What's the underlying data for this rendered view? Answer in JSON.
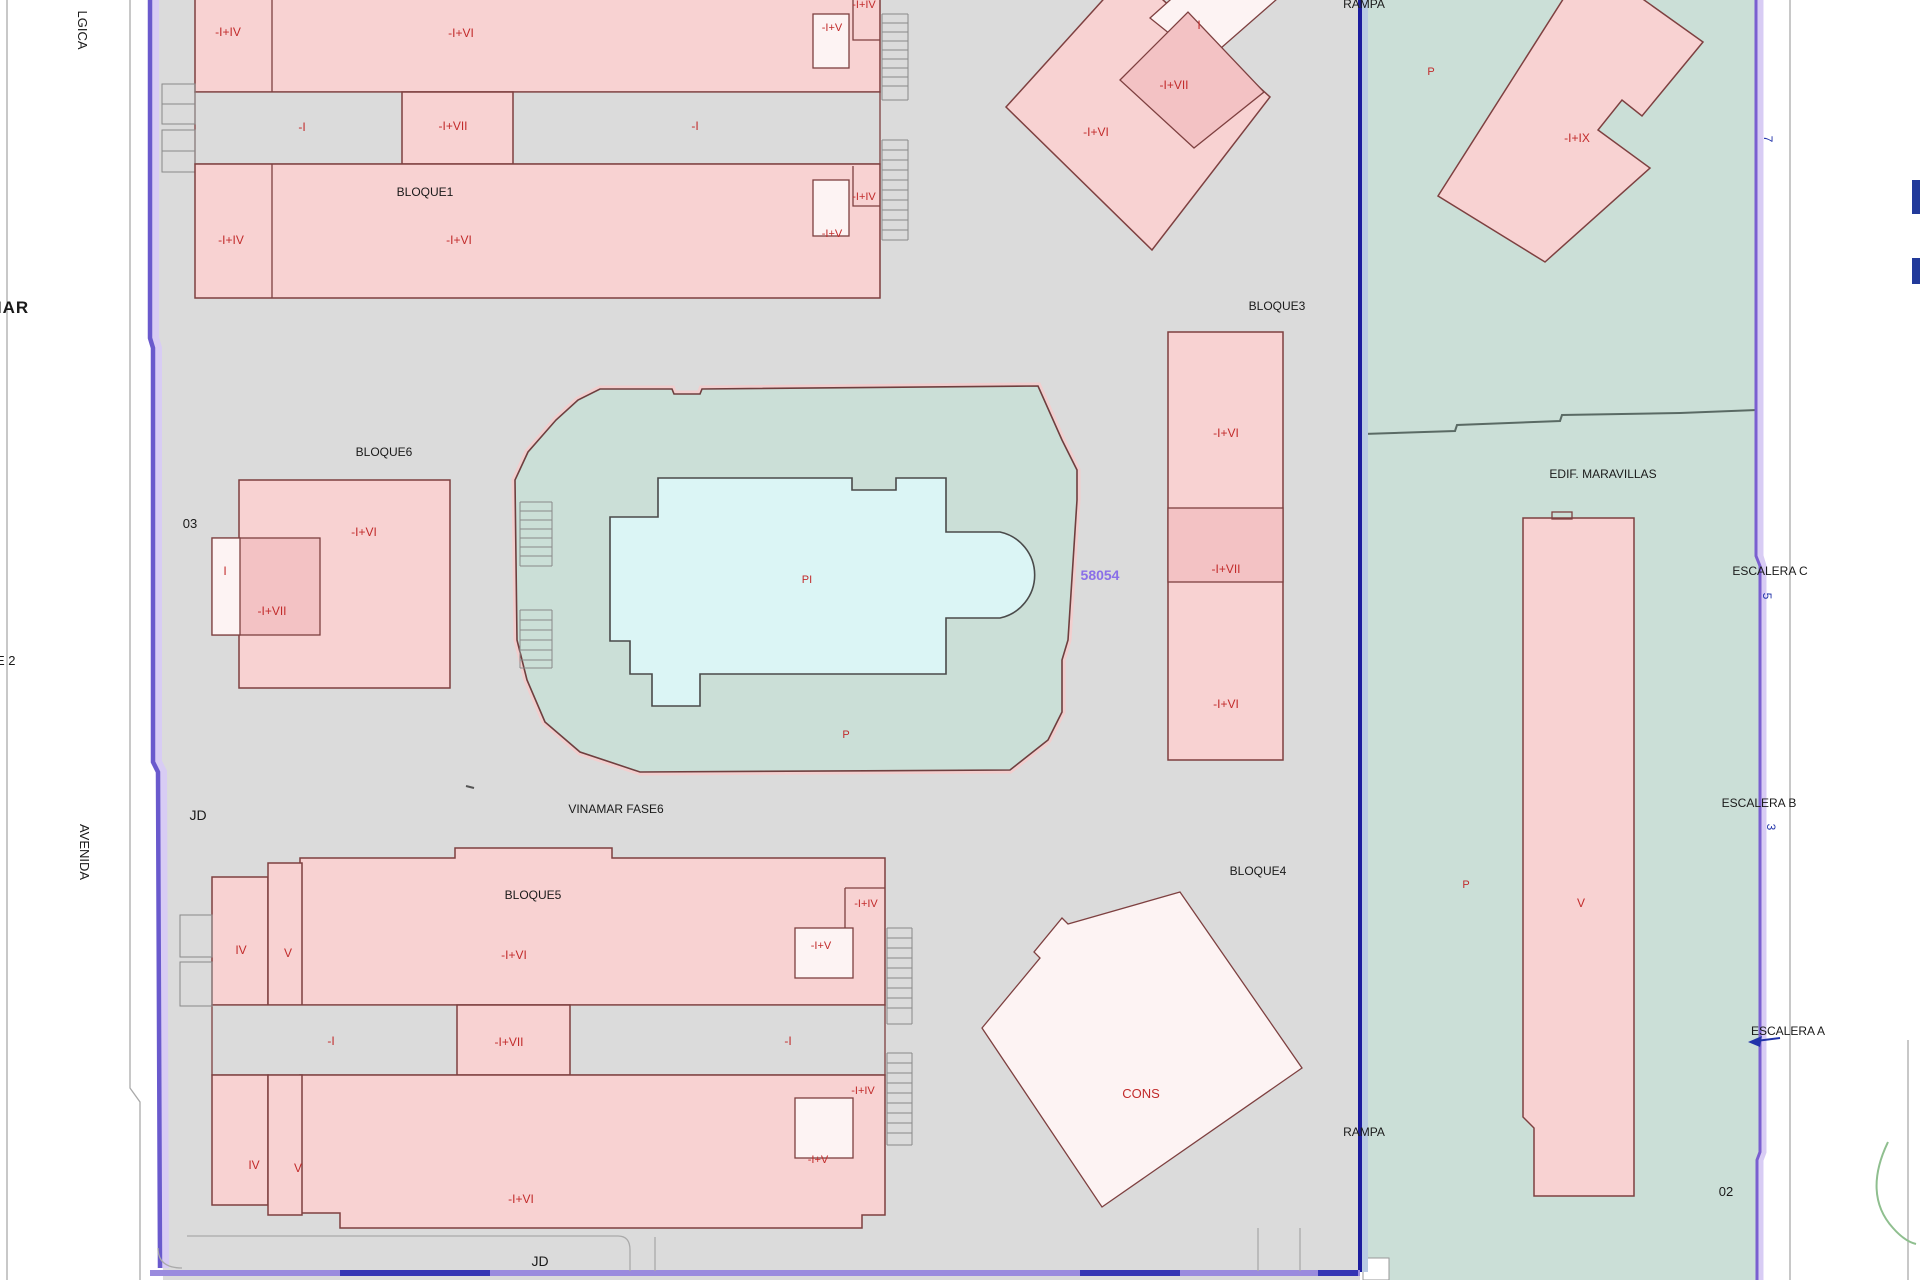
{
  "palette": {
    "background": "#ffffff",
    "parcel_gray": "#dbdbdb",
    "building_pink": "#f8d2d2",
    "building_pink_dark": "#f3c2c4",
    "building_pale": "#fdf3f3",
    "building_outline": "#7e4040",
    "label_red": "#c22b2b",
    "green_zone": "#cbdfd7",
    "pool_cyan": "#dbf5f5",
    "boundary_purple": "#6a5acd",
    "divider_navy": "#1b1b9e",
    "parcel_number_purple": "#8a6fe8",
    "street_line_gray": "#aaaaaa"
  },
  "streets": {
    "belgica_clipped": "LGICA",
    "vinamar": "VINAMAR",
    "bloque2_clipped": "QUE 2",
    "avenida": "AVENIDA",
    "jd_west": "JD",
    "jd_south": "JD"
  },
  "parcel": {
    "number": "58054",
    "plot_03": "03",
    "plot_02": "02",
    "rampa_top": "RAMPA",
    "rampa_bottom": "RAMPA",
    "fase6": "VINAMAR FASE6"
  },
  "bloque1": {
    "title": "BLOQUE1",
    "top_left": "-I+IV",
    "top_main": "-I+VI",
    "strip_left": "-I",
    "strip_mid": "-I+VII",
    "strip_right": "-I",
    "top_right_outer": "-I+IV",
    "top_right_inner": "-I+V",
    "bottom_left": "-I+IV",
    "bottom_main": "-I+VI",
    "bottom_right_outer": "-I+IV",
    "bottom_right_inner": "-I+V"
  },
  "bloque2_diamond": {
    "main": "-I+VI",
    "inner": "-I+VII",
    "band": "I"
  },
  "bloque3": {
    "title": "BLOQUE3",
    "top": "-I+VI",
    "mid": "-I+VII",
    "bottom": "-I+VI"
  },
  "bloque4": {
    "title": "BLOQUE4",
    "cons": "CONS"
  },
  "bloque5": {
    "title": "BLOQUE5",
    "top_iv": "IV",
    "top_v": "V",
    "top_main": "-I+VI",
    "strip_left": "-I",
    "strip_mid": "-I+VII",
    "strip_right": "-I",
    "top_right_outer": "-I+IV",
    "top_right_inner": "-I+V",
    "bottom_iv": "IV",
    "bottom_v": "V",
    "bottom_main": "-I+VI",
    "bottom_right_outer": "-I+IV",
    "bottom_right_inner": "-I+V"
  },
  "bloque6": {
    "title": "BLOQUE6",
    "main": "-I+VI",
    "inner": "-I+VII",
    "left": "I"
  },
  "pool": {
    "label": "PI",
    "deck": "P"
  },
  "maravillas": {
    "title": "EDIF. MARAVILLAS",
    "tower": "V",
    "building_ix": "-I+IX",
    "park_upper": "P",
    "park_lower": "P",
    "escalera_a": "ESCALERA A",
    "escalera_b": "ESCALERA B",
    "escalera_c": "ESCALERA C",
    "num_7": "7",
    "num_5": "5",
    "num_3": "3"
  }
}
